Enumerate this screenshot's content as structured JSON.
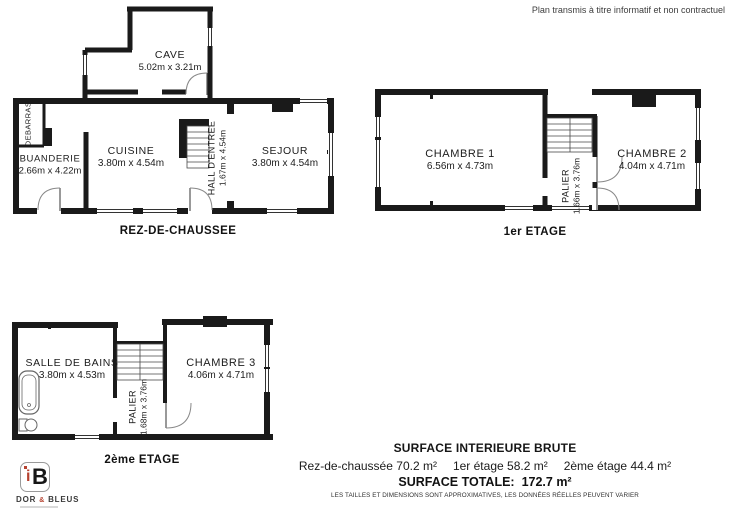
{
  "disclaimer": "Plan transmis à titre informatif et non contractuel",
  "floors": {
    "ground": {
      "label": "REZ-DE-CHAUSSEE",
      "rooms": {
        "cave": {
          "name": "CAVE",
          "dims": "5.02m x 3.21m"
        },
        "debarras": {
          "name": "DEBARRAS"
        },
        "buanderie": {
          "name": "BUANDERIE",
          "dims": "2.66m x 4.22m"
        },
        "cuisine": {
          "name": "CUISINE",
          "dims": "3.80m x 4.54m"
        },
        "hall": {
          "name": "HALL D'ENTREE",
          "dims": "1.67m x 4.54m"
        },
        "sejour": {
          "name": "SEJOUR",
          "dims": "3.80m x 4.54m"
        }
      }
    },
    "first": {
      "label": "1er ETAGE",
      "rooms": {
        "chambre1": {
          "name": "CHAMBRE 1",
          "dims": "6.56m x 4.73m"
        },
        "palier": {
          "name": "PALIER",
          "dims": "1.66m x 3.76m"
        },
        "chambre2": {
          "name": "CHAMBRE 2",
          "dims": "4.04m x 4.71m"
        }
      }
    },
    "second": {
      "label": "2ème ETAGE",
      "rooms": {
        "salle_de_bains": {
          "name": "SALLE DE BAINS",
          "dims": "3.80m x 4.53m"
        },
        "palier": {
          "name": "PALIER",
          "dims": "1.68m x 3.76m"
        },
        "chambre3": {
          "name": "CHAMBRE 3",
          "dims": "4.06m x 4.71m"
        }
      }
    }
  },
  "summary": {
    "title": "SURFACE INTERIEURE BRUTE",
    "areas": [
      {
        "label": "Rez-de-chaussée",
        "value": "70.2 m²"
      },
      {
        "label": "1er étage",
        "value": "58.2 m²"
      },
      {
        "label": "2ème étage",
        "value": "44.4 m²"
      }
    ],
    "total_label": "SURFACE TOTALE:",
    "total_value": "172.7 m²",
    "note": "LES TAILLES ET DIMENSIONS SONT APPROXIMATIVES, LES DONNÉES RÉELLES PEUVENT VARIER"
  },
  "logo": {
    "letter_i": "i",
    "letter_b": "B",
    "name_prefix": "DOR",
    "amp": "&",
    "name_suffix": "BLEUS"
  },
  "colors": {
    "wall": "#1a1a1a",
    "accent": "#b5402e",
    "text": "#1f1f1f"
  }
}
